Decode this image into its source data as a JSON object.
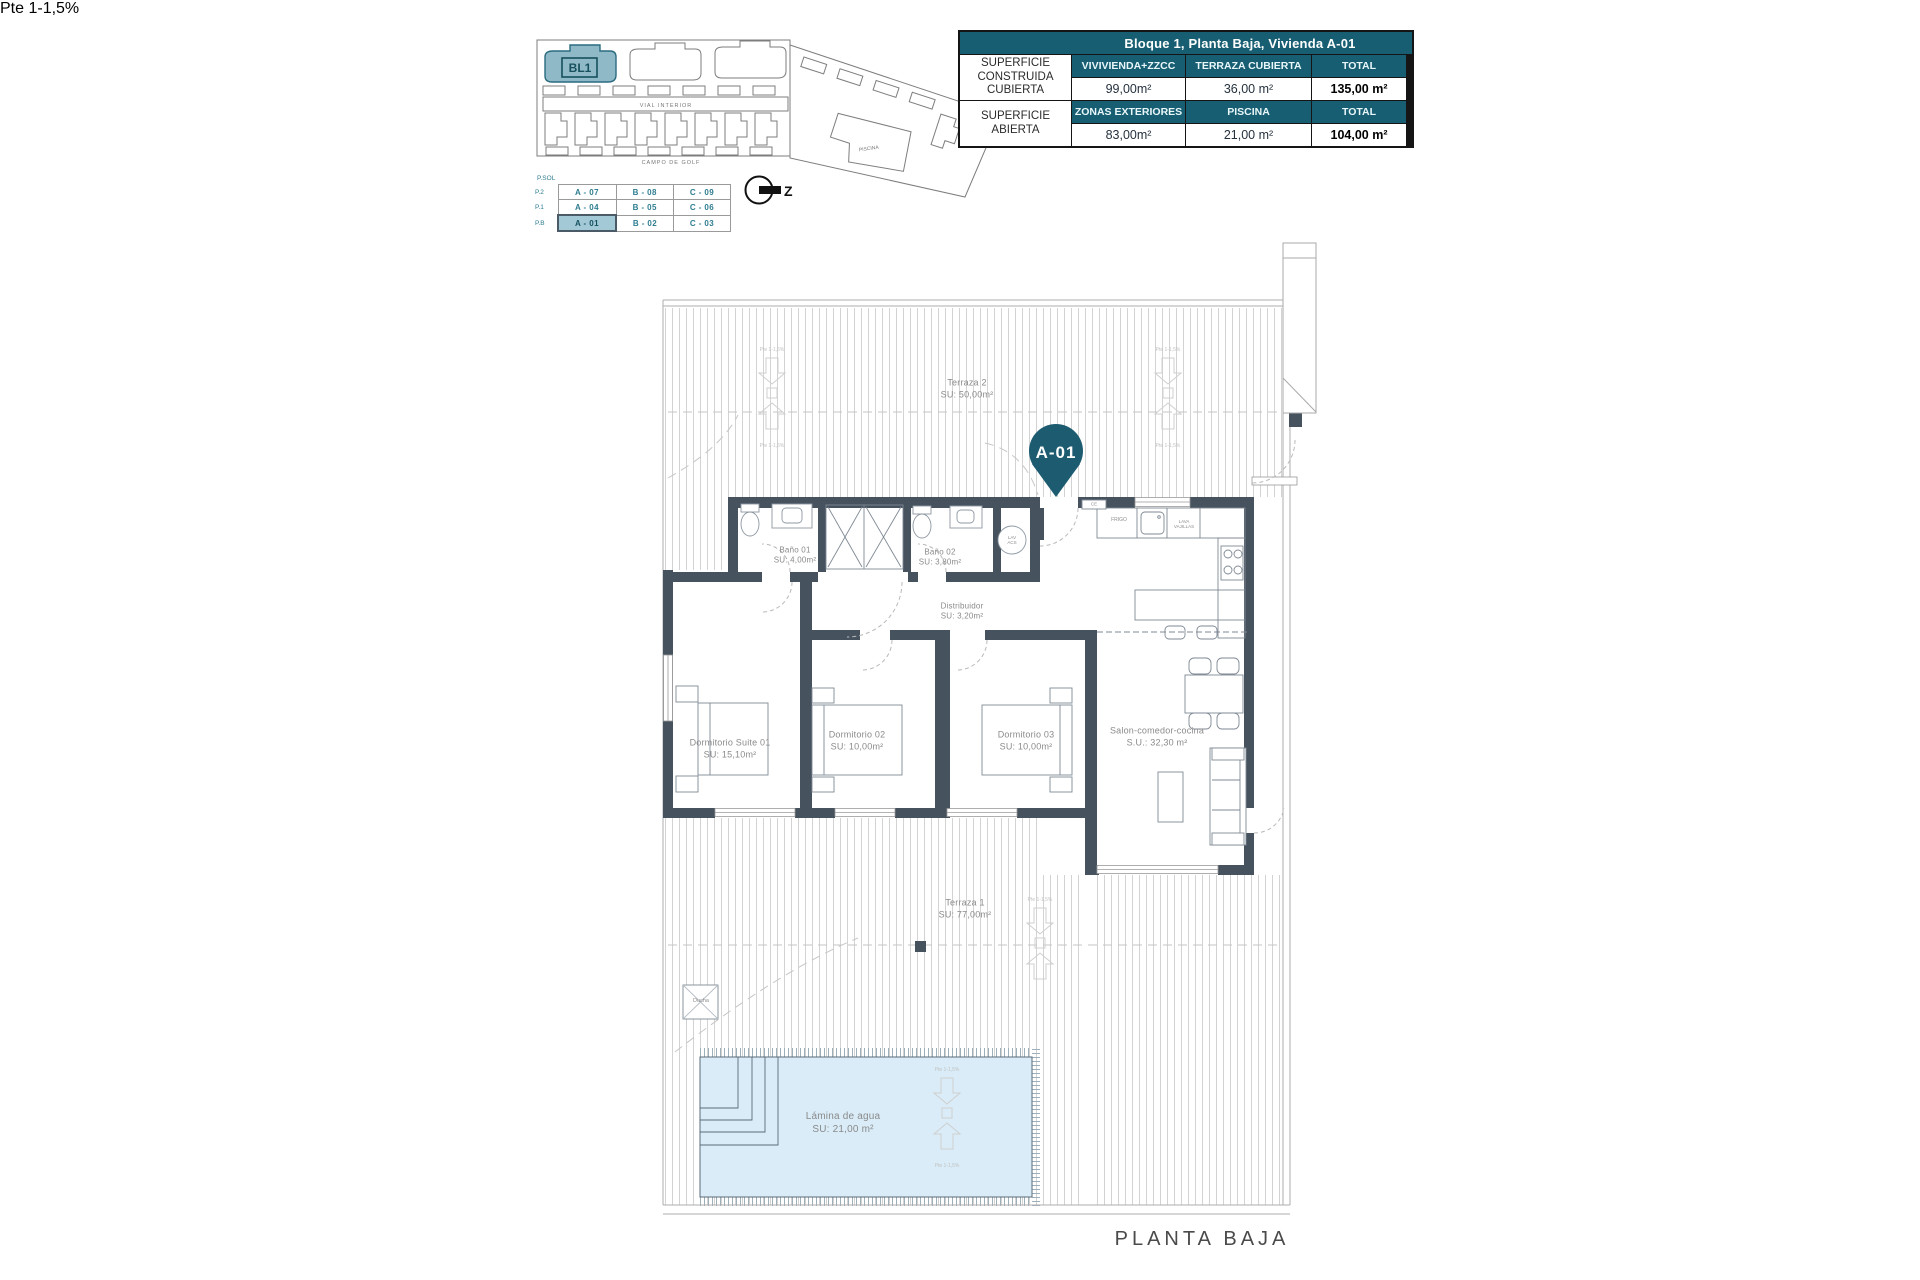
{
  "site_plan": {
    "block_label": "BL1",
    "road_label": "VIAL INTERIOR",
    "golf_label": "CAMPO DE GOLF",
    "piscina_label": "PISCINA",
    "north_letter": "Z"
  },
  "units_table": {
    "corner_label": "P.SOL",
    "levels": [
      "P.2",
      "P.1",
      "P.B"
    ],
    "rows": [
      [
        "A - 07",
        "B - 08",
        "C - 09"
      ],
      [
        "A - 04",
        "B - 05",
        "C - 06"
      ],
      [
        "A - 01",
        "B - 02",
        "C - 03"
      ]
    ],
    "highlighted_unit": "A - 01"
  },
  "summary_table": {
    "title": "Bloque 1, Planta Baja, Vivienda A-01",
    "section1": {
      "label": "SUPERFICIE CONSTRUIDA CUBIERTA",
      "col1": "VIVIVIENDA+ZZCC",
      "col2": "TERRAZA CUBIERTA",
      "col3": "TOTAL",
      "val1": "99,00m²",
      "val2": "36,00 m²",
      "val3": "135,00 m²"
    },
    "section2": {
      "label": "SUPERFICIE ABIERTA",
      "col1": "ZONAS EXTERIORES",
      "col2": "PISCINA",
      "col3": "TOTAL",
      "val1": "83,00m²",
      "val2": "21,00 m²",
      "val3": "104,00 m²"
    }
  },
  "floor_plan": {
    "pin": "A-01",
    "title": "PLANTA BAJA",
    "slope_label": "Pte 1-1,5%",
    "rooms": {
      "terraza2": {
        "name": "Terraza 2",
        "area": "SU: 50,00m²"
      },
      "bano1": {
        "name": "Baño 01",
        "area": "SU: 4,00m²"
      },
      "bano2": {
        "name": "Baño 02",
        "area": "SU: 3,80m²"
      },
      "distribuidor": {
        "name": "Distribuidor",
        "area": "SU: 3,20m²"
      },
      "suite01": {
        "name": "Dormitorio Suite 01",
        "area": "SU: 15,10m²"
      },
      "dorm02": {
        "name": "Dormitorio 02",
        "area": "SU: 10,00m²"
      },
      "dorm03": {
        "name": "Dormitorio 03",
        "area": "SU: 10,00m²"
      },
      "salon": {
        "name": "Salon-comedor-cocina",
        "area": "S.U.: 32,30 m²"
      },
      "terraza1": {
        "name": "Terraza 1",
        "area": "SU: 77,00m²"
      },
      "lamina": {
        "name": "Lámina de agua",
        "area": "SU: 21,00 m²"
      },
      "ducha": {
        "name": "Ducha"
      }
    },
    "fixtures": {
      "frigo": "FRIGO",
      "lavavajillas": "LAVA VAJILLAS",
      "lav_acs": "LAV ACS",
      "ce": "CE"
    },
    "colors": {
      "teal": "#175e72",
      "wall": "#47525f",
      "pool": "#d9ecf7",
      "highlight": "#a3c9d6"
    }
  }
}
